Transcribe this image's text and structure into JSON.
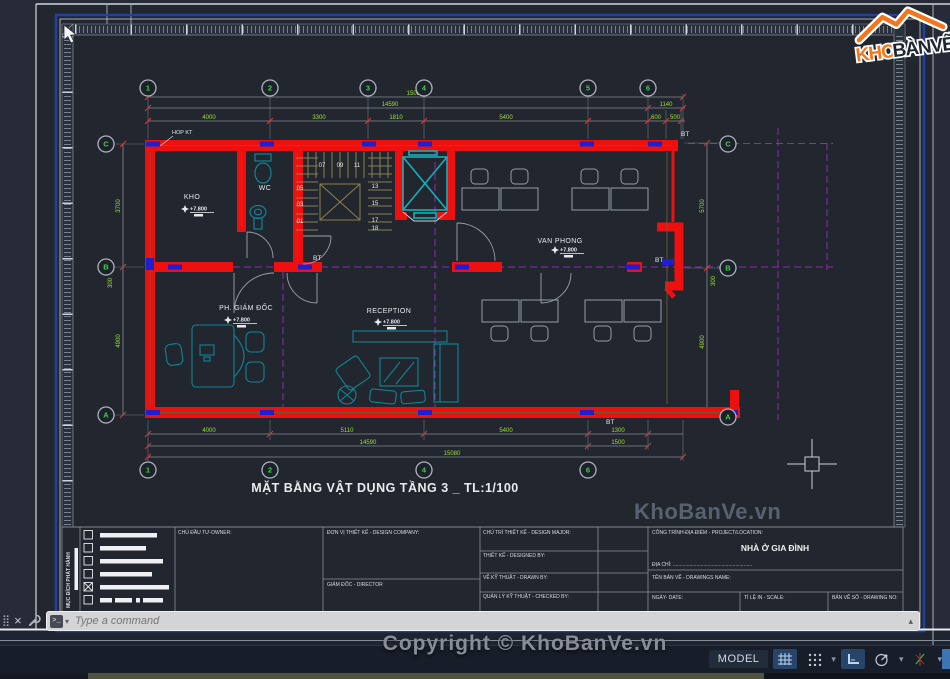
{
  "command": {
    "placeholder": "Type a command"
  },
  "footer": {
    "copyright": "Copyright © KhoBanVe.vn"
  },
  "watermark": {
    "text": "KhoBanVe.vn"
  },
  "logo": {
    "kho": "KHO",
    "banve": "BÀNVẼ"
  },
  "status_bar": {
    "model": "MODEL"
  },
  "drawing": {
    "title": "MẶT BẰNG VẬT DỤNG TẦNG 3 _ TL:1/100",
    "rooms": [
      {
        "name": "KHO",
        "level": "+7.800"
      },
      {
        "name": "WC"
      },
      {
        "name": "VAN PHONG",
        "level": "+7.800"
      },
      {
        "name": "PH. GIÁM ĐỐC",
        "level": "+7.800"
      },
      {
        "name": "RECEPTION",
        "level": "+7.800"
      }
    ],
    "annotations": {
      "bt": "BT",
      "hop_kt": "HOP KT"
    },
    "stairs": {
      "top": [
        "07",
        "09",
        "11"
      ],
      "left": [
        "05",
        "03",
        "01"
      ],
      "right": [
        "13",
        "15",
        "17",
        "18"
      ]
    },
    "grid": {
      "top": [
        "1",
        "2",
        "3",
        "4",
        "5",
        "6"
      ],
      "bottom": [
        "1",
        "2",
        "4",
        "6"
      ],
      "left": [
        "C",
        "B",
        "A"
      ],
      "right": [
        "C",
        "B",
        "A"
      ]
    },
    "dims": {
      "top_segments": [
        "4000",
        "3300",
        "1810",
        "5400"
      ],
      "top_right_segments": [
        "600",
        "500"
      ],
      "top_total_1": "14590",
      "top_total_2": "15080",
      "top_right_total": "1140",
      "bottom_segments": [
        "4000",
        "5110",
        "5400",
        "1300"
      ],
      "bottom_total_1": "14590",
      "bottom_right_small": "1500",
      "bottom_total_2": "15080",
      "left": [
        "3700",
        "4900"
      ],
      "left_small": "300",
      "right": [
        "5700",
        "4900"
      ],
      "right_small": "300"
    }
  },
  "title_block": {
    "purpose_title": "MỤC ĐÍCH PHÁT HÀNH",
    "owner": "CHỦ ĐẦU TƯ-OWNER:",
    "design_company": "ĐƠN VỊ THIẾT KẾ - DESIGN COMPANY:",
    "director": "GIÁM ĐỐC - DIRECTOR",
    "design_major": "CHỦ TRÌ THIẾT KẾ - DESIGN MAJOR:",
    "designed_by": "THIẾT KẾ - DESIGNED BY:",
    "drawn_by": "VẼ KỸ THUẬT - DRAWN BY:",
    "checked_by": "QUẢN LÝ KỸ THUẬT - CHECKED BY:",
    "project_location": "CÔNG TRÌNH-ĐỊA ĐIỂM - PROJECT/LOCATION:",
    "project_name": "NHÀ Ở GIA ĐÌNH",
    "address": "ĐỊA CHỈ: .........................................................",
    "drawing_name": "TÊN BẢN VẼ - DRAWINGS NAME:",
    "date": "NGÀY- DATE:",
    "scale": "TỈ LỆ IN - SCALE:",
    "drawing_no": "BẢN VẼ SỐ - DRAWING NO:"
  },
  "colors": {
    "wall_red": "#ee0f0f",
    "column_blue": "#1f1fd2",
    "elevator_teal": "#18aeb8",
    "furniture_teal": "#0f8496",
    "dim_green": "#9ce032",
    "grid_magenta": "#8f2ab3",
    "viewport_blue": "#2140a0",
    "logo_orange": "#f1761d"
  }
}
